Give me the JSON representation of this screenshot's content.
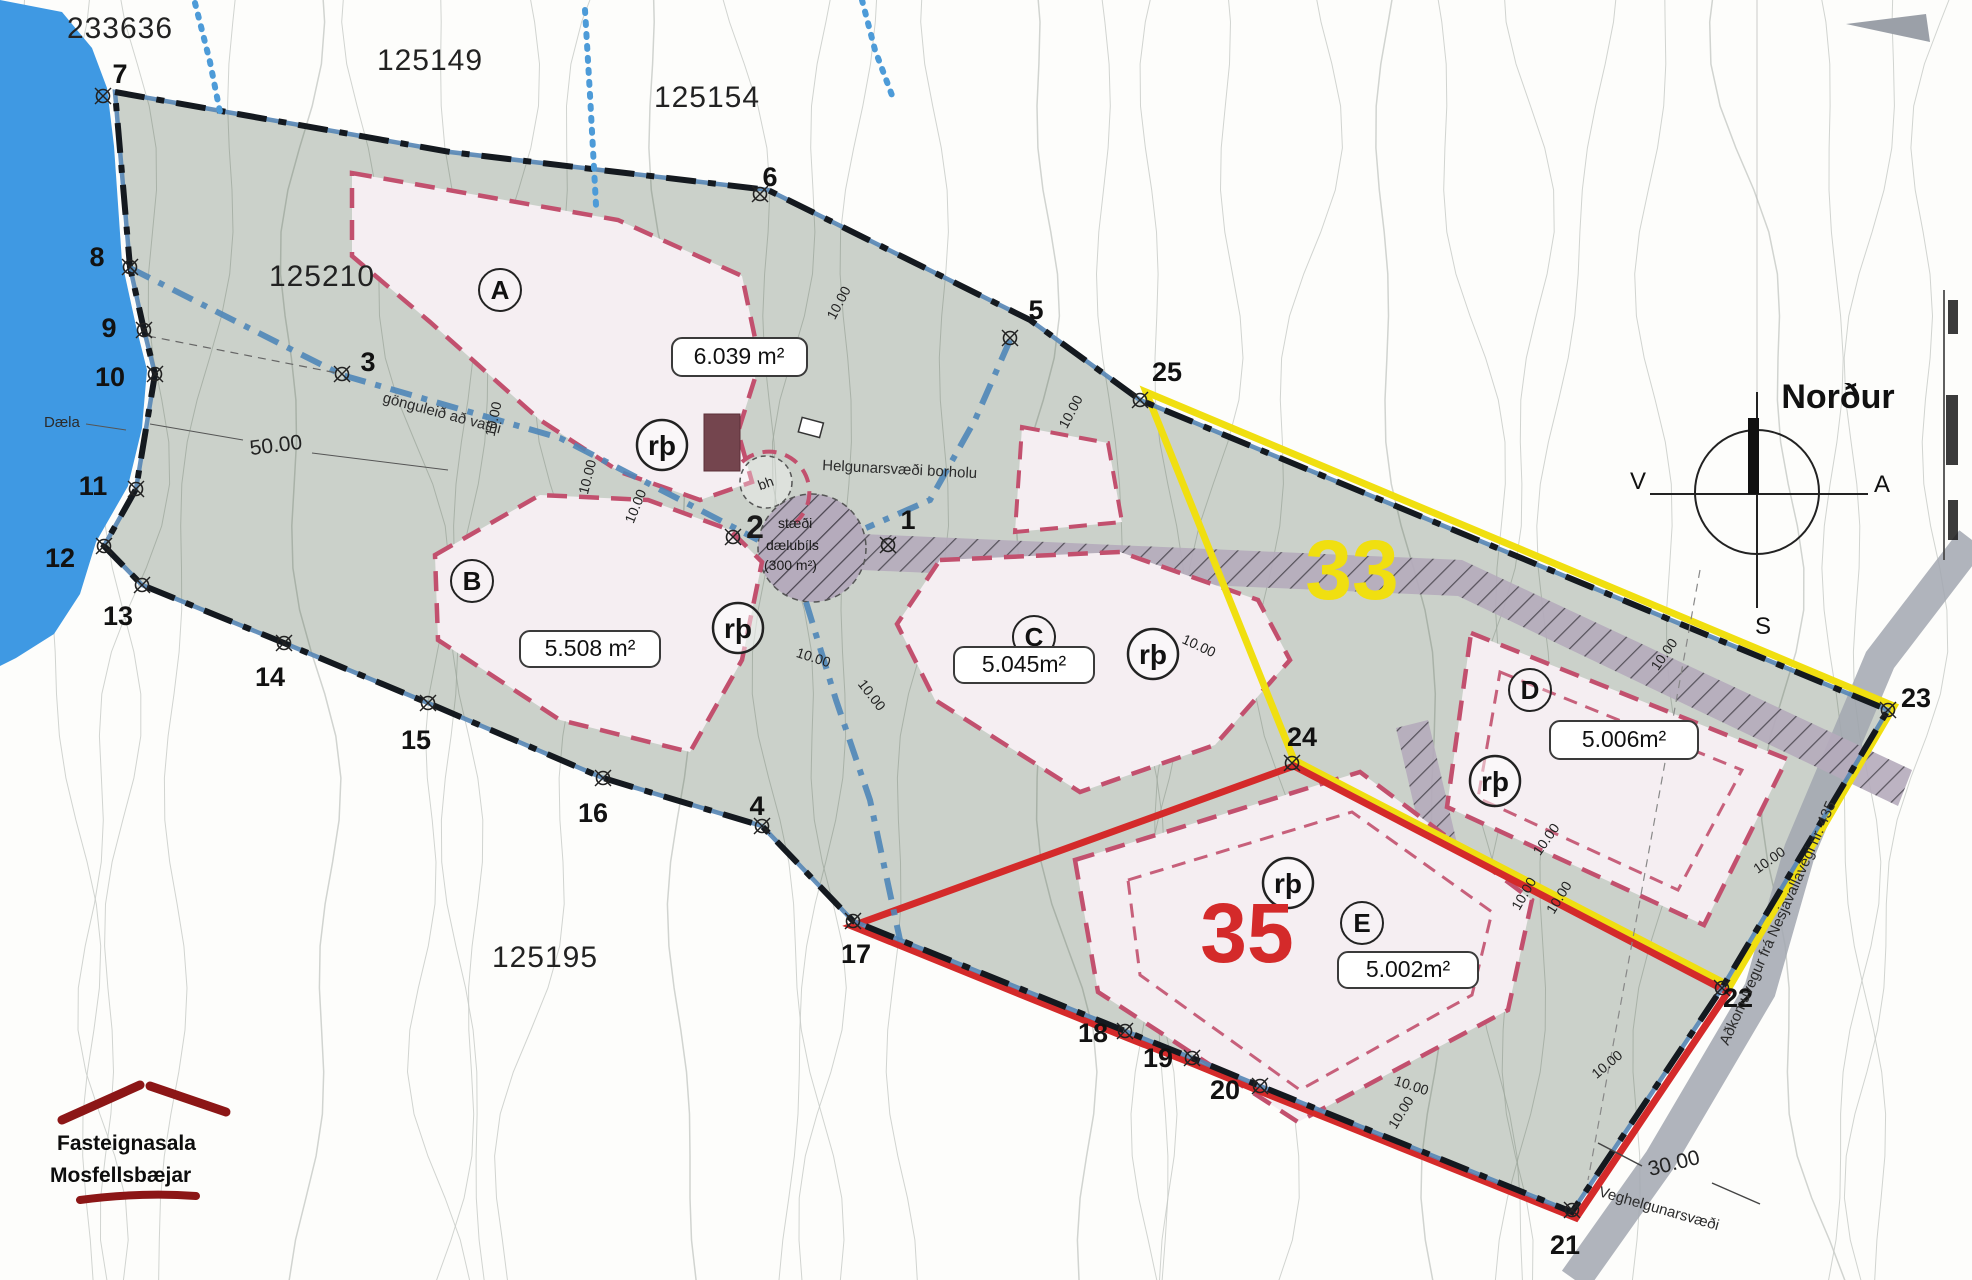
{
  "map": {
    "plot_numbers": {
      "p233636": "233636",
      "p125149": "125149",
      "p125154": "125154",
      "p125210": "125210",
      "p125195": "125195"
    },
    "points": {
      "1": "1",
      "2": "2",
      "3": "3",
      "4": "4",
      "5": "5",
      "6": "6",
      "7": "7",
      "8": "8",
      "9": "9",
      "10": "10",
      "11": "11",
      "12": "12",
      "13": "13",
      "14": "14",
      "15": "15",
      "16": "16",
      "17": "17",
      "18": "18",
      "19": "19",
      "20": "20",
      "21": "21",
      "22": "22",
      "23": "23",
      "24": "24",
      "25": "25"
    },
    "parcels": [
      {
        "id": "A",
        "area": "6.039 m²"
      },
      {
        "id": "B",
        "area": "5.508 m²"
      },
      {
        "id": "C",
        "area": "5.045m²"
      },
      {
        "id": "D",
        "area": "5.006m²"
      },
      {
        "id": "E",
        "area": "5.002m²"
      }
    ],
    "zones": [
      {
        "number": "33"
      },
      {
        "number": "35"
      }
    ],
    "symbols": {
      "rp": "rþ",
      "bh": "bh"
    },
    "labels": {
      "daela": "Dæla",
      "path": "gönguleið að vatni",
      "borehole_zone": "Helgunarsvæði borholu",
      "parking_line1": "stæði",
      "parking_line2": "dælubíls",
      "parking_line3": "(300 m²)",
      "road_name": "Aðkomuvegur frá Nesjavallavegi nr. 435",
      "road_zone": "Veghelgunarsvæði"
    },
    "dimensions": {
      "d50": "50.00",
      "d30": "30.00",
      "d10": "10.00"
    },
    "compass": {
      "title": "Norður",
      "w": "V",
      "e": "A",
      "s": "S"
    },
    "logo": {
      "line1": "Fasteignasala",
      "line2": "Mosfellsbæjar"
    },
    "colors": {
      "zone33": "#f0df10",
      "zone35": "#d42a2a",
      "lake": "#3f99e3",
      "site": "#cbd1ca",
      "parcel_border": "#c2506e"
    }
  }
}
